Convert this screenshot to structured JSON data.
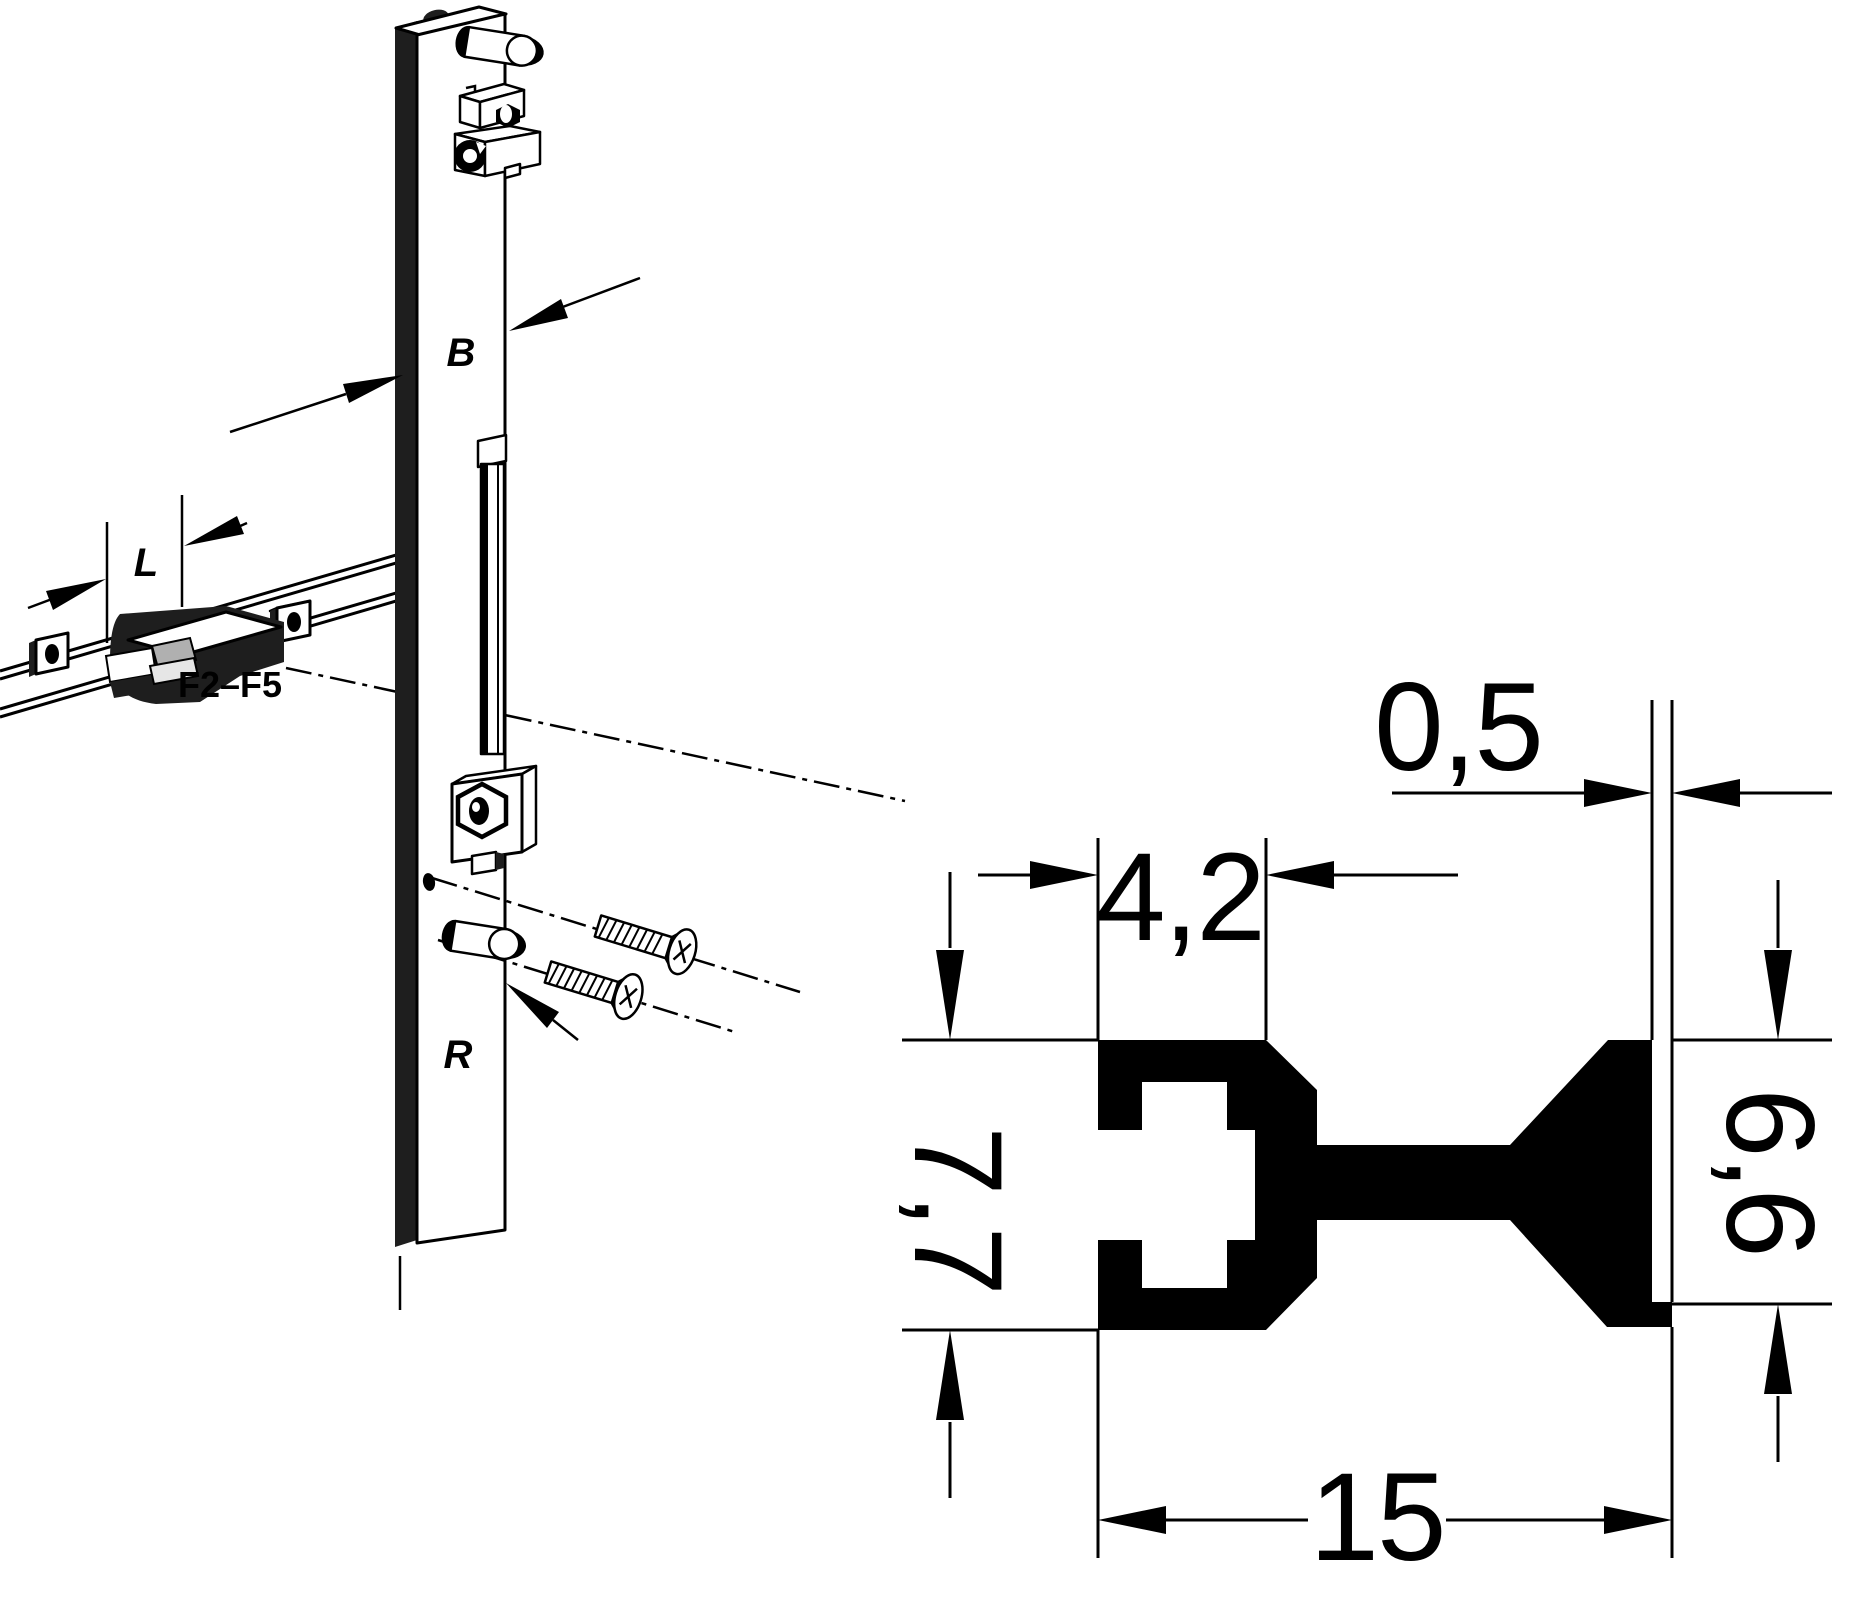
{
  "canvas": {
    "width": 1855,
    "height": 1598,
    "background": "#ffffff"
  },
  "figure_left": {
    "label_b": "B",
    "label_l": "L",
    "label_r": "R",
    "label_range": "F2–F5"
  },
  "figure_right": {
    "dim_gap": "0,5",
    "dim_slot_width": "4,2",
    "dim_left_height": "7,7",
    "dim_right_height": "6,6",
    "dim_overall_width": "15"
  },
  "colors": {
    "ink": "#000000",
    "dark_fill": "#1e1e1e",
    "insert_gray": "#b0b0b0",
    "insert_light_gray": "#e6e6e6"
  }
}
